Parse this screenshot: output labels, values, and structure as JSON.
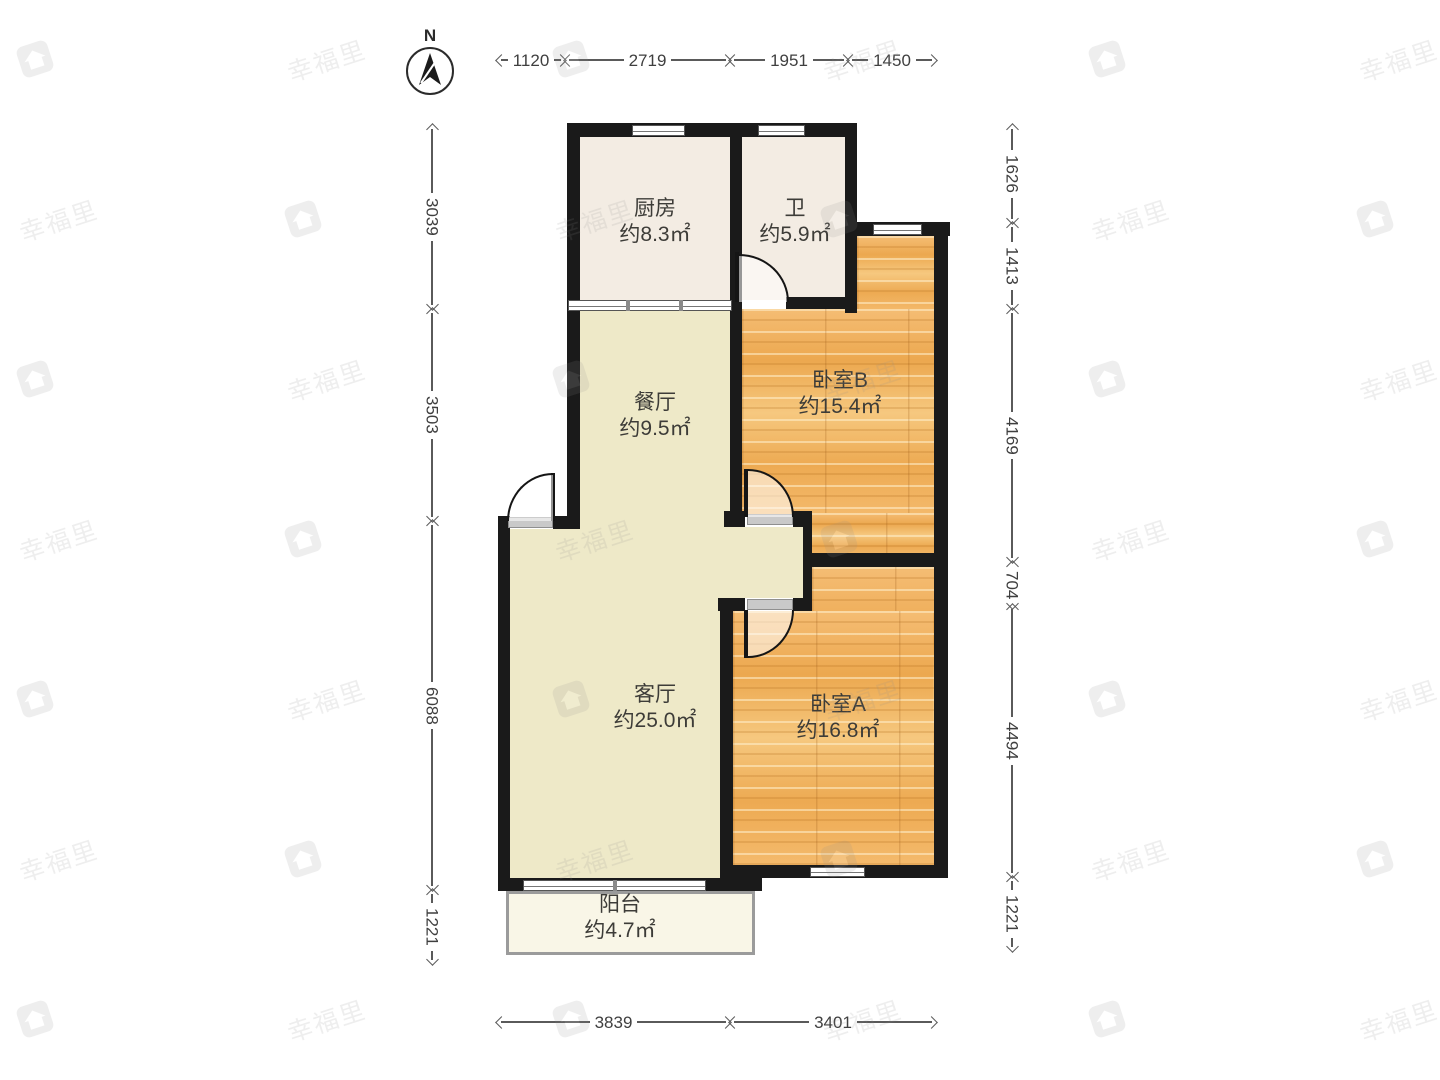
{
  "compass": {
    "label": "N"
  },
  "watermark": {
    "text": "幸福里"
  },
  "rooms": {
    "kitchen": {
      "name": "厨房",
      "area": "约8.3㎡"
    },
    "bath": {
      "name": "卫",
      "area": "约5.9㎡"
    },
    "bedroom_b": {
      "name": "卧室B",
      "area": "约15.4㎡"
    },
    "dining": {
      "name": "餐厅",
      "area": "约9.5㎡"
    },
    "living": {
      "name": "客厅",
      "area": "约25.0㎡"
    },
    "bedroom_a": {
      "name": "卧室A",
      "area": "约16.8㎡"
    },
    "balcony": {
      "name": "阳台",
      "area": "约4.7㎡"
    }
  },
  "dimensions": {
    "top": {
      "y": 60,
      "segments": [
        {
          "label": "1120",
          "from": 497,
          "to": 565
        },
        {
          "label": "2719",
          "from": 565,
          "to": 730
        },
        {
          "label": "1951",
          "from": 730,
          "to": 848
        },
        {
          "label": "1450",
          "from": 848,
          "to": 936
        }
      ]
    },
    "bottom": {
      "y": 1022,
      "segments": [
        {
          "label": "3839",
          "from": 497,
          "to": 730
        },
        {
          "label": "3401",
          "from": 730,
          "to": 936
        }
      ]
    },
    "left": {
      "x": 432,
      "segments": [
        {
          "label": "3039",
          "from": 125,
          "to": 309
        },
        {
          "label": "3503",
          "from": 309,
          "to": 521
        },
        {
          "label": "6088",
          "from": 521,
          "to": 890
        },
        {
          "label": "1221",
          "from": 890,
          "to": 964
        }
      ]
    },
    "right": {
      "x": 1012,
      "segments": [
        {
          "label": "1626",
          "from": 125,
          "to": 223
        },
        {
          "label": "1413",
          "from": 223,
          "to": 309
        },
        {
          "label": "4169",
          "from": 309,
          "to": 562
        },
        {
          "label": "704",
          "from": 562,
          "to": 605
        },
        {
          "label": "4494",
          "from": 605,
          "to": 877
        },
        {
          "label": "1221",
          "from": 877,
          "to": 951
        }
      ]
    }
  },
  "colors": {
    "wall": "#1a1a1a",
    "wood": "#f0b061",
    "hall": "#eee9c8",
    "tile": "#f3ece3",
    "balcony": "#f9f6e7",
    "dimension": "#4a4a4a"
  }
}
